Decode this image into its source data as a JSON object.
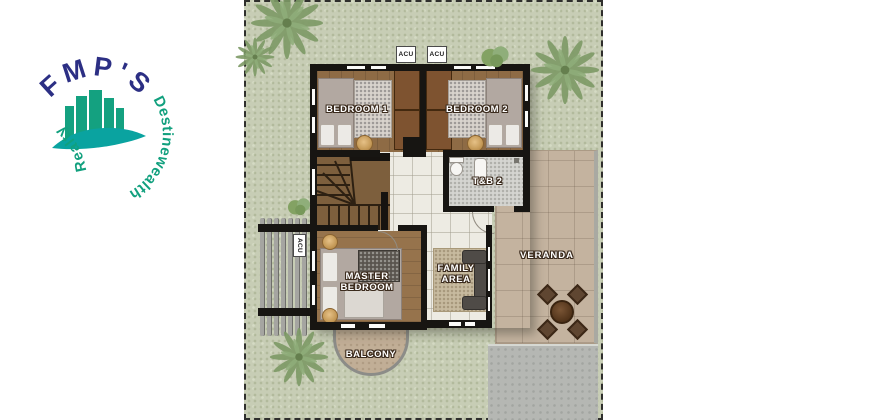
{
  "logo": {
    "top": "FMP'S",
    "right": "Destinewealth",
    "left": "Realty",
    "navy": "#2c2f84",
    "teal": "#11a07e"
  },
  "rooms": {
    "bedroom1": "BEDROOM 1",
    "bedroom2": "BEDROOM 2",
    "tnb2": "T&B 2",
    "master": "MASTER BEDROOM",
    "family": "FAMILY AREA",
    "veranda": "VERANDA",
    "balcony": "BALCONY"
  },
  "equipment": {
    "acu_top_1": "ACU",
    "acu_top_2": "ACU",
    "acu_side": "ACU"
  },
  "palette": {
    "grass": "#c7cdb5",
    "veranda_floor": "#c4b39f",
    "driveway": "#b5b7b3",
    "wall": "#171512",
    "wood_floor": "#8e6b45",
    "tile_floor": "#edebe3",
    "balcony_floor": "#c1ae96"
  }
}
